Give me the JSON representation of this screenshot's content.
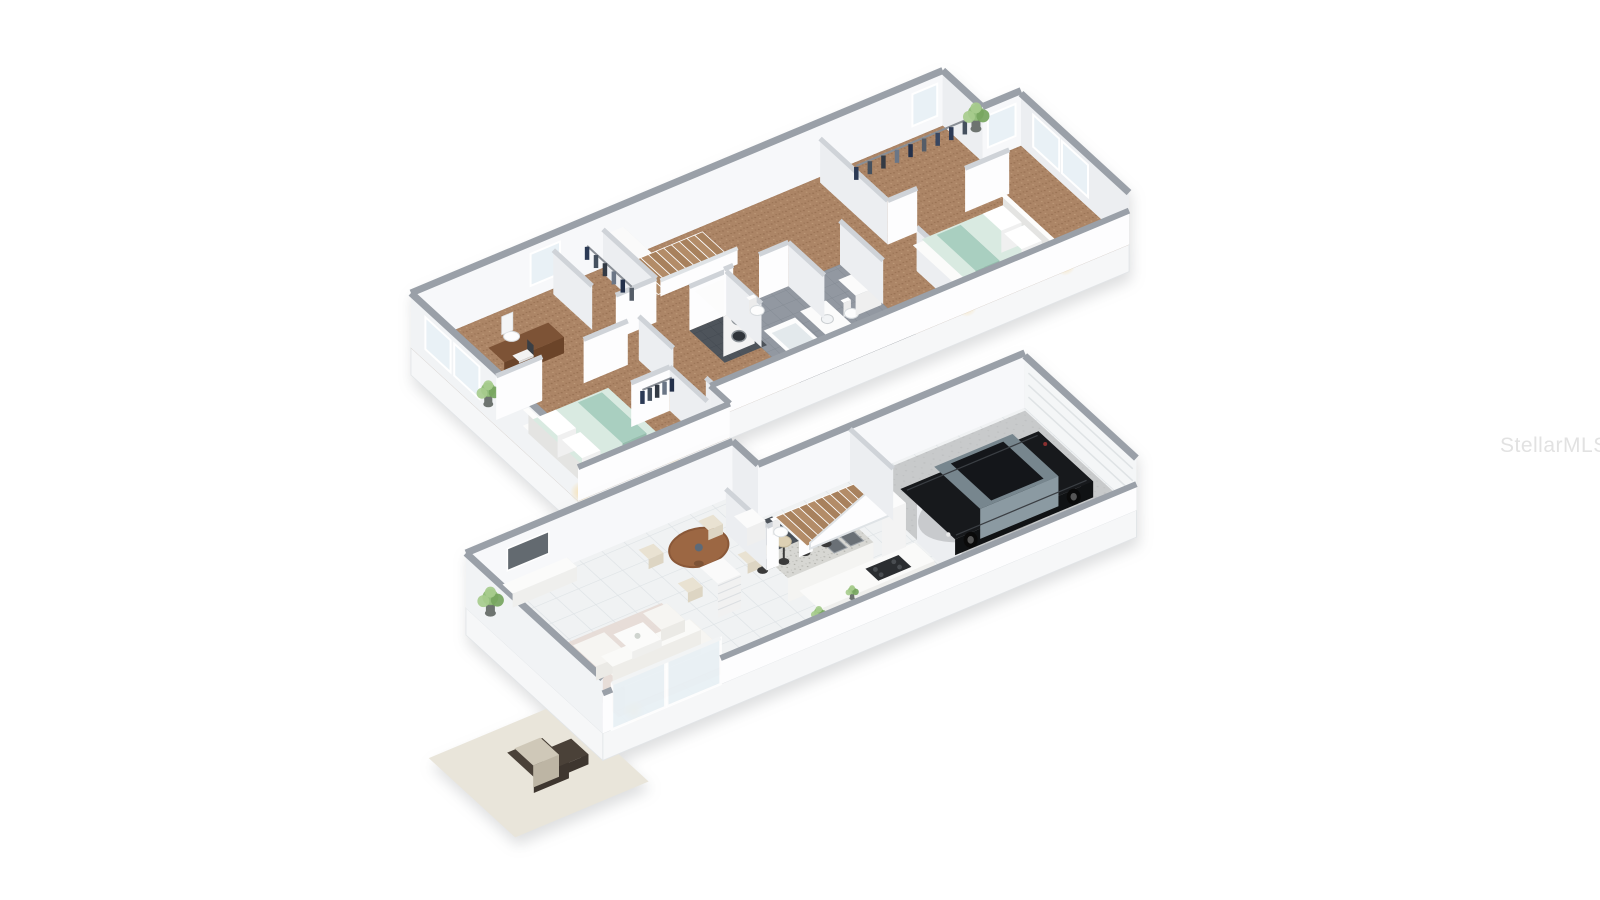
{
  "watermark": {
    "text": "StellarMLS",
    "color": "#e2e2e2"
  },
  "scene_type": "3d-isometric-floor-plan",
  "palette": {
    "background": "#ffffff",
    "wallCapExt": "#9aa0a8",
    "wallCapInt": "#cfd3d8",
    "wallCapLow": "#dfe3e6",
    "wallFace": "#fdfdfe",
    "wallFaceShade": "#eceef1",
    "wallFaceBack": "#f7f8fa",
    "wallFaceWest": "#f1f3f5",
    "skirt": "#f6f7f8",
    "skirtEdge": "#e2e5e8",
    "carpet": "#ac8566",
    "carpetDot1": "#977152",
    "carpetDot2": "#bf9b7a",
    "tile": "#f0f2f3",
    "tileLine": "#dde2e5",
    "bathTile": "#9298a1",
    "bathTileLine": "#848b94",
    "darkTile": "#4e545b",
    "darkTileLine": "#434951",
    "concrete": "#c8cacb",
    "concreteDot": "#bfc1c2",
    "granite": "#d7d7d3",
    "graniteDot1": "#b9b9b4",
    "graniteDot2": "#a9a9a3",
    "wood": "#9c6743",
    "woodDark": "#7d5336",
    "deskWood": "#7d5336",
    "mint": "#d9eae1",
    "mintDark": "#a9cfc0",
    "furnWhite": "#f6f5f2",
    "furnWhiteShade": "#e6e5e1",
    "rug": "#e6dbd6",
    "cream": "#ddd0b4",
    "plantGreen": "#8cba72",
    "plantGreenLight": "#a7cc8d",
    "plantGreenDark": "#76a55e",
    "pot": "#6e7470",
    "carBlack": "#17191c",
    "carBlackSide": "#0c0e10",
    "glass": "#8b9aa2",
    "glassTop": "#77868e",
    "windowGlass": "#e9f1f6",
    "patio": "#e9e5da",
    "outdoorBrown": "#4a4138",
    "outdoorCushion": "#cfc8b8",
    "glow": "#f7dfae",
    "steel": "#8f959a",
    "applianceDark": "#2f343a"
  },
  "floors": [
    {
      "id": "upper-floor",
      "label": "Upper Floor",
      "rooms": [
        "office",
        "bedroom-2",
        "closet",
        "hallway",
        "stairs-down",
        "laundry-closet",
        "bathroom",
        "water-closet",
        "master-bedroom",
        "walk-in-closet"
      ],
      "inventory": [
        "desk",
        "office-chair",
        "laptop",
        "potted-plant",
        "bed",
        "pillows",
        "throw-blanket",
        "clothes-rack",
        "linen-shelves",
        "stacked-washer-dryer",
        "bathtub",
        "vanity-sink",
        "toilet",
        "windows",
        "bedside-lamps"
      ]
    },
    {
      "id": "lower-floor",
      "label": "Lower Floor",
      "rooms": [
        "living-room",
        "dining-area",
        "kitchen",
        "entry-hall",
        "half-bath",
        "stairs-up",
        "garage",
        "patio"
      ],
      "inventory": [
        "tv",
        "tv-console",
        "sectional-sofa",
        "armchair",
        "coffee-table",
        "area-rug",
        "floor-lamp",
        "potted-plant",
        "round-dining-table",
        "dining-chairs",
        "kitchen-island",
        "bar-stools",
        "double-sink",
        "cooktop",
        "refrigerator",
        "toilet",
        "vanity-sink",
        "car",
        "garage-door",
        "sliding-glass-doors",
        "outdoor-lounge-chair"
      ]
    }
  ]
}
